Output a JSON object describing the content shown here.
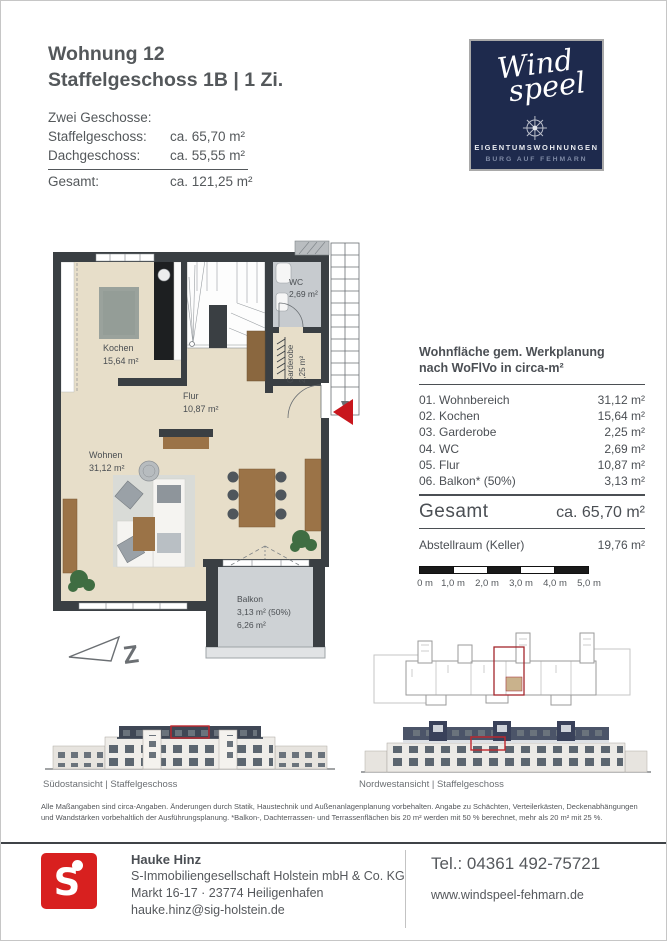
{
  "header": {
    "title_line1": "Wohnung 12",
    "title_line2": "Staffelgeschoss 1B | 1 Zi.",
    "specs_intro": "Zwei Geschosse:",
    "specs": [
      {
        "label": "Staffelgeschoss:",
        "value": "ca. 65,70 m²"
      },
      {
        "label": "Dachgeschoss:",
        "value": "ca. 55,55 m²"
      }
    ],
    "total_label": "Gesamt:",
    "total_value": "ca. 121,25 m²"
  },
  "logo": {
    "brand_line1": "Wind",
    "brand_line2": "speel",
    "subtitle": "EIGENTUMSWOHNUNGEN",
    "location": "BURG AUF FEHMARN",
    "bg_color": "#1e2a4d"
  },
  "floor_plan": {
    "rooms": {
      "kochen": {
        "name": "Kochen",
        "area": "15,64 m²"
      },
      "flur": {
        "name": "Flur",
        "area": "10,87 m²"
      },
      "wohnen": {
        "name": "Wohnen",
        "area": "31,12 m²"
      },
      "wc": {
        "name": "WC",
        "area": "2,69 m²"
      },
      "garderobe": {
        "name": "Garderobe",
        "area": "2,25 m²"
      },
      "balkon": {
        "name": "Balkon",
        "area_line1": "3,13 m²  (50%)",
        "area_line2": "6,26 m²"
      }
    },
    "north_letter": "Z",
    "colors": {
      "wall": "#3a3f43",
      "floor": "#e7dec9",
      "wc_floor": "#c7cbcf",
      "balcony_floor": "#ced2d5",
      "highlight_red": "#c8161d"
    }
  },
  "area_table": {
    "title_line1": "Wohnfläche gem. Werkplanung",
    "title_line2": "nach WoFlVo in circa-m²",
    "rows": [
      {
        "label": "01. Wohnbereich",
        "value": "31,12 m²"
      },
      {
        "label": "02. Kochen",
        "value": "15,64 m²"
      },
      {
        "label": "03. Garderobe",
        "value": "2,25 m²"
      },
      {
        "label": "04. WC",
        "value": "2,69 m²"
      },
      {
        "label": "05. Flur",
        "value": "10,87 m²"
      },
      {
        "label": "06. Balkon* (50%)",
        "value": "3,13 m²"
      }
    ],
    "total_label": "Gesamt",
    "total_value": "ca. 65,70 m²",
    "extra_label": "Abstellraum (Keller)",
    "extra_value": "19,76 m²"
  },
  "scale_bar": {
    "labels": [
      "0 m",
      "1,0 m",
      "2,0 m",
      "3,0 m",
      "4,0 m",
      "5,0 m"
    ]
  },
  "elevations": [
    {
      "caption": "Südostansicht | Staffelgeschoss"
    },
    {
      "caption": "Nordwestansicht | Staffelgeschoss"
    }
  ],
  "disclaimer": "Alle Maßangaben sind circa-Angaben. Änderungen durch Statik, Haustechnik und Außenanlagenplanung vorbehalten. Angabe zu Schächten, Verteilerkästen, Deckenabhängungen und Wandstärken vorbehaltlich der Ausführungsplanung. *Balkon-, Dachterrassen- und Terrassenflächen bis 20 m² werden mit 50 % berechnet, mehr als 20 m² mit 25 %.",
  "footer": {
    "contact_name": "Hauke Hinz",
    "company": "S-Immobiliengesellschaft Holstein mbH & Co. KG",
    "address": "Markt 16-17 · 23774 Heiligenhafen",
    "email": "hauke.hinz@sig-holstein.de",
    "phone": "Tel.: 04361 492-75721",
    "website": "www.windspeel-fehmarn.de"
  }
}
